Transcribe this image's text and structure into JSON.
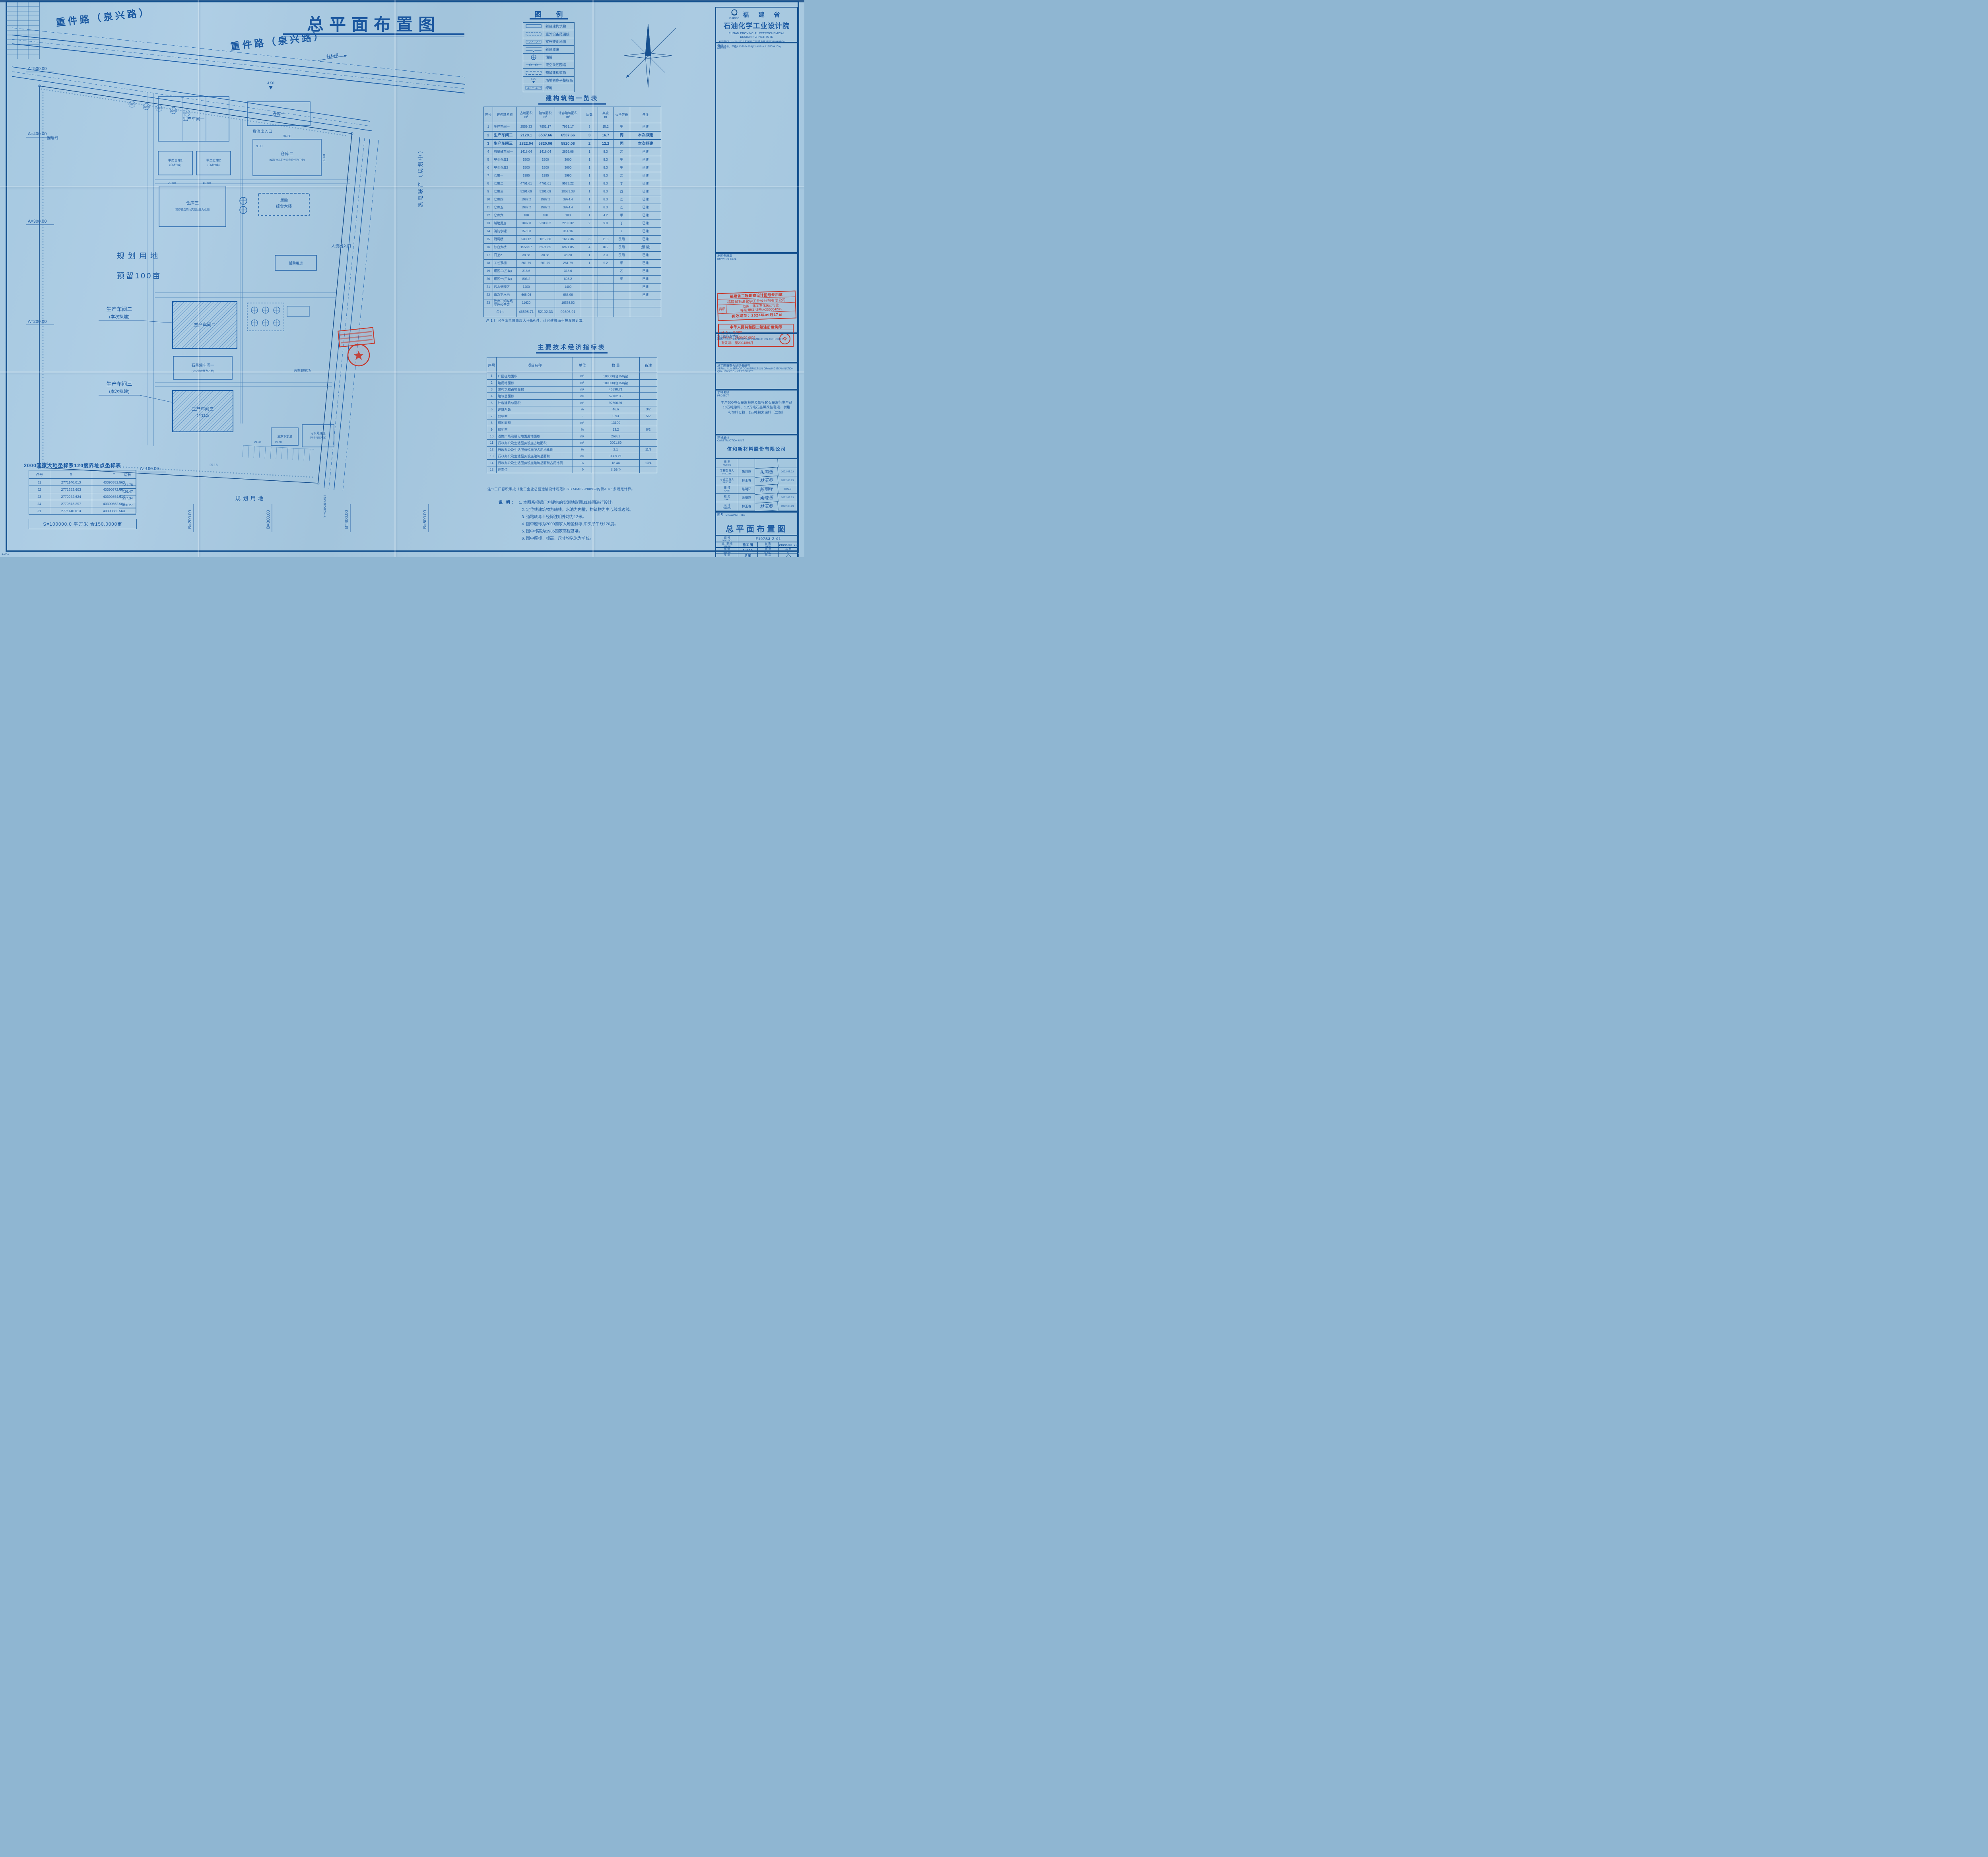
{
  "main_title": "总平面布置图",
  "corner_code": "1.0A1",
  "colors": {
    "ink": "#1c5aa2",
    "frame": "#14518f",
    "stamp_red": "#c5372b"
  },
  "legend": {
    "title": "图 例",
    "items": [
      {
        "symbol": "solid-rect",
        "label": "新建建构筑物"
      },
      {
        "symbol": "dashdot-rect",
        "label": "室外设备范围线"
      },
      {
        "symbol": "hatch-rect",
        "label": "室外硬化地面"
      },
      {
        "symbol": "road",
        "label": "新建道路"
      },
      {
        "symbol": "tank",
        "label": "储罐"
      },
      {
        "symbol": "fence",
        "label": "镂空铁艺围墙"
      },
      {
        "symbol": "dashed-rect",
        "label": "预留建构筑物"
      },
      {
        "symbol": "elevation-mark",
        "label": "场地初步平整标高",
        "value": "4.20"
      },
      {
        "symbol": "green-strip",
        "label": "绿地"
      }
    ]
  },
  "building_table": {
    "title": "建构筑物一览表",
    "headers": [
      {
        "label": "序号",
        "unit": ""
      },
      {
        "label": "建构筑名称",
        "unit": ""
      },
      {
        "label": "占地面积",
        "unit": "m²"
      },
      {
        "label": "建筑面积",
        "unit": "m²"
      },
      {
        "label": "计容建筑面积",
        "unit": "m²"
      },
      {
        "label": "层数",
        "unit": ""
      },
      {
        "label": "高度",
        "unit": "m"
      },
      {
        "label": "火险等级",
        "unit": ""
      },
      {
        "label": "备注",
        "unit": ""
      }
    ],
    "rows": [
      [
        "1",
        "生产车间一",
        "2559.33",
        "7951.17",
        "7951.17",
        "3",
        "15.2",
        "甲",
        "已建"
      ],
      [
        "2",
        "生产车间二",
        "2129.1",
        "6537.66",
        "6537.66",
        "3",
        "16.7",
        "丙",
        "本次拟建"
      ],
      [
        "3",
        "生产车间三",
        "2822.04",
        "5820.06",
        "5820.06",
        "2",
        "12.2",
        "丙",
        "本次拟建"
      ],
      [
        "4",
        "石墨烯车间一",
        "1418.04",
        "1418.04",
        "2836.08",
        "1",
        "8.3",
        "乙",
        "已建"
      ],
      [
        "5",
        "甲类仓库1",
        "1500",
        "1500",
        "3000",
        "1",
        "8.3",
        "甲",
        "已建"
      ],
      [
        "6",
        "甲类仓库2",
        "1500",
        "1500",
        "3000",
        "1",
        "8.3",
        "甲",
        "已建"
      ],
      [
        "7",
        "仓库一",
        "1995",
        "1995",
        "3990",
        "1",
        "8.3",
        "乙",
        "已建"
      ],
      [
        "8",
        "仓库二",
        "4761.61",
        "4761.61",
        "9523.22",
        "1",
        "8.3",
        "丁",
        "已建"
      ],
      [
        "9",
        "仓库三",
        "5291.69",
        "5291.69",
        "10583.38",
        "1",
        "8.3",
        "戊",
        "已建"
      ],
      [
        "10",
        "仓库四",
        "1987.2",
        "1987.2",
        "3974.4",
        "1",
        "8.3",
        "乙",
        "已建"
      ],
      [
        "11",
        "仓库五",
        "1987.2",
        "1987.2",
        "3974.4",
        "1",
        "8.3",
        "乙",
        "已建"
      ],
      [
        "12",
        "仓库六",
        "180",
        "180",
        "180",
        "1",
        "4.2",
        "甲",
        "已建"
      ],
      [
        "13",
        "辅助用房",
        "1097.8",
        "2283.32",
        "2283.32",
        "2",
        "9.0",
        "丁",
        "已建"
      ],
      [
        "14",
        "消防水罐",
        "157.08",
        "",
        "314.16",
        "",
        "",
        "/",
        "已建"
      ],
      [
        "15",
        "附属楼",
        "533.12",
        "1617.36",
        "1617.36",
        "3",
        "11.3",
        "民用",
        "已建"
      ],
      [
        "16",
        "综合大楼",
        "1558.57",
        "6971.85",
        "6971.85",
        "4",
        "16.7",
        "民用",
        "(预 留)"
      ],
      [
        "17",
        "门卫2",
        "38.38",
        "38.38",
        "38.38",
        "1",
        "3.3",
        "民用",
        "已建"
      ],
      [
        "18",
        "工艺泵棚",
        "261.79",
        "261.79",
        "261.79",
        "1",
        "5.2",
        "甲",
        "已建"
      ],
      [
        "19",
        "罐区二(乙类)",
        "318.6",
        "",
        "318.6",
        "",
        "",
        "乙",
        "已建"
      ],
      [
        "20",
        "罐区一(甲类)",
        "803.2",
        "",
        "803.2",
        "",
        "",
        "甲",
        "已建"
      ],
      [
        "21",
        "污水处理区",
        "1400",
        "",
        "1400",
        "",
        "",
        "",
        "已建"
      ],
      [
        "22",
        "清净下水池",
        "668.96",
        "",
        "668.96",
        "",
        "",
        "",
        "已建"
      ],
      [
        "23",
        "管廊、卸车场 室外设备等",
        "11630",
        "",
        "16558.92",
        "",
        "",
        "",
        ""
      ]
    ],
    "total": {
      "label": "合计:",
      "a": "46598.71",
      "b": "52102.33",
      "c": "92606.91"
    },
    "note": "注:1 厂房仓库单层高度大于8米时，计容建筑面积按双层计算。"
  },
  "indicator_table": {
    "title": "主要技术经济指标表",
    "headers": [
      "序号",
      "项目名称",
      "单位",
      "数  量",
      "备注"
    ],
    "rows": [
      [
        "1",
        "厂区征地面积",
        "m²",
        "100000(合150亩)",
        ""
      ],
      [
        "2",
        "建用地面积",
        "m²",
        "100000(合150亩)",
        ""
      ],
      [
        "3",
        "建构筑物占地面积",
        "m²",
        "46598.71",
        ""
      ],
      [
        "4",
        "建筑总面积",
        "m²",
        "52102.33",
        ""
      ],
      [
        "5",
        "计容建筑总面积",
        "m²",
        "92606.91",
        ""
      ],
      [
        "6",
        "建筑系数",
        "%",
        "46.6",
        "3/2"
      ],
      [
        "7",
        "容积率",
        "-",
        "0.93",
        "5/2"
      ],
      [
        "8",
        "绿地面积",
        "m²",
        "13190",
        ""
      ],
      [
        "9",
        "绿地率",
        "%",
        "13.2",
        "8/2"
      ],
      [
        "10",
        "道路广场及硬化地面用地面积",
        "m²",
        "26882",
        ""
      ],
      [
        "11",
        "行政办公及生活服务设施占地面积",
        "m²",
        "2091.69",
        ""
      ],
      [
        "12",
        "行政办公及生活服务设施所占用地比例",
        "%",
        "2.1",
        "11/2"
      ],
      [
        "13",
        "行政办公及生活服务设施建筑总面积",
        "m²",
        "8589.21",
        ""
      ],
      [
        "14",
        "行政办公及生活服务设施建筑总面积占用比例",
        "%",
        "18.44",
        "13/4"
      ],
      [
        "15",
        "停车位",
        "个",
        "共93个",
        ""
      ]
    ],
    "note": "注:1工厂容积率按《化工企业总图运输设计规范》GB 50489-2009中的第A.4.1条规定计算。"
  },
  "coord_table": {
    "title": "2000国家大地坐标系120度界址点坐标表",
    "headers": [
      "点号",
      "X",
      "Y",
      "边长"
    ],
    "rows": [
      {
        "pt": "J1",
        "x": "2771140.013",
        "y": "40390382.563"
      },
      {
        "pt": "J2",
        "x": "2771272.603",
        "y": "40390572.667"
      },
      {
        "pt": "J3",
        "x": "2770952.624",
        "y": "40390854.614"
      },
      {
        "pt": "J4",
        "x": "2770813.257",
        "y": "40390662.504"
      },
      {
        "pt": "J1",
        "x": "2771140.013",
        "y": "40390382.563"
      }
    ],
    "sides": [
      "231.78",
      "426.47",
      "237.34",
      "430.27"
    ],
    "footer": "S=100000.0 平方米 合150.0000亩"
  },
  "notes": {
    "label": "说 明：",
    "items": [
      "1. 本图系根据厂方提供的实测地形图.红线图进行设计。",
      "2. 定位线建筑物为轴线，水池为内壁，构筑物为中心线或边线。",
      "3. 道路转弯半径除注明外均为12米。",
      "4. 图中座标为2000国家大地坐标系,中央子午线120度。",
      "5. 图中标高为1985国家高程基准。",
      "6. 图中座标、标高、尺寸均以米为单位。"
    ]
  },
  "title_block": {
    "logo": "FJPEC",
    "org_cn1": "福 建 省",
    "org_cn2": "石油化学工业设计院",
    "org_en1": "FUJIAN PROVINCIAL PETROCHEMICAL",
    "org_en2": "DESIGNING INSTITUTE",
    "cert1": "发证部门：中华人民共和国住房和城乡建设部(MOHURD)",
    "cert2": "证书编号：甲级A135004209(CLASS A A135004209)",
    "notes_cn": "备注",
    "notes_en": "NOTES",
    "seal_cn": "出图专用章",
    "seal_en": "DRAWING SEAL",
    "exam_cn": "施工图审查单位",
    "exam_en": "CONSTRUCTION DRAWING EXAMINATION AUTHORITY",
    "serial_cn": "施工图审查合格证书编号",
    "serial_en": "SERIAL NUMBER OF CONSTRUCTION DRAWING EXAMINATION QUALIFICATION CERTIFICATE",
    "project_cn": "工程名称",
    "project_en": "PROJECT",
    "project_l1": "年产500吨石墨烯粉体及规模化石墨烯衍生产品",
    "project_l2": "10万吨涂料、1.2万吨石墨烯改性乳液、树脂",
    "project_l3": "和塑料母粒、2万吨粉末涂料（二期）",
    "unit_cn": "建设单位",
    "unit_en": "CONSTRUCTION UNIT",
    "unit_name": "信和新材料股份有限公司",
    "sign_rows": [
      {
        "cn": "审  定",
        "en": "AUTH'D",
        "name": "",
        "date": ""
      },
      {
        "cn": "工程负责人",
        "en": "PROJ.M.",
        "name": "朱鸿燕",
        "date": "2022.08.23"
      },
      {
        "cn": "专业负责人",
        "en": "SPEC.M.",
        "name": "林玉春",
        "date": "2022.08.23"
      },
      {
        "cn": "审  核",
        "en": "APPR",
        "name": "陈明环",
        "date": "2022.8"
      },
      {
        "cn": "校  对",
        "en": "CHKD",
        "name": "余晓燕",
        "date": "2022.08.23"
      },
      {
        "cn": "设  计",
        "en": "DRAWN",
        "name": "林玉春",
        "date": "2022.08.23"
      }
    ],
    "dtitle_cn": "图名",
    "dtitle_en": "DRAWING TITLE",
    "drawing_title": "总平面布置图",
    "dwgno_cn": "图  号",
    "dwgno_en": "DWG.NO.",
    "dwg_no": "F107S3-Z-01",
    "stage_cn": "设计阶段",
    "stage_en": "STAGE",
    "stage": "施工图",
    "date_cn": "日  期",
    "date_en": "DATE",
    "date": "2022.08.23",
    "scale_cn": "比  例",
    "scale_en": "SCALE",
    "scale": "1:500",
    "sheet_cn": "第  页",
    "sheet_en": "SHEET",
    "of_cn": "共  页",
    "of_en": "OF",
    "spec_cn": "专  业",
    "spec_en": "SPEC.",
    "spec": "总图",
    "rev_cn": "版  次",
    "rev_en": "REV.",
    "rev": "0"
  },
  "stamps": {
    "s1_l1": "福建省工程勘察设计图纸专用章",
    "s1_l2": "福建省石油化学工业设计院有限公司",
    "s1_zz": "资质",
    "s1_scope": "范围：化工石化医药行业",
    "s1_grade": "等级:甲级  证号:A235004206",
    "s1_valid": "有效期至：2024年09月17日",
    "s2_title": "中华人民共和国二级注册建筑师",
    "s2_name": "姓 名：  陈明环",
    "s2_no": "注册号：  3500420-0002",
    "s2_valid": "有效期：  至2024年6月"
  },
  "plan": {
    "road_label_1": "重件路（泉兴路）",
    "road_label_2": "重件路（泉兴路）",
    "to_wharf": "往码头",
    "freight_gate": "货流出入口",
    "people_gate": "人流出入口",
    "fence_label": "围墙线",
    "planning_left_l1": "规划用地",
    "planning_left_l2": "预留100亩",
    "planning_bottom": "规划用地",
    "chp_vertical": "热电联产（规划中）",
    "callout2_l1": "生产车间二",
    "callout2_l2": "(本次拟建)",
    "callout3_l1": "生产车间三",
    "callout3_l2": "(本次拟建)",
    "bld": {
      "ws1": "生产车间一",
      "jia1": "甲类仓库1",
      "jia1_note": "(自动仓库)",
      "jia2": "甲类仓库2",
      "jia2_note": "(自动仓库)",
      "wh1": "仓库一",
      "wh2": "仓库二",
      "wh2_note": "(储存物品的火灾危险性为丁类)",
      "wh3": "仓库三",
      "wh3_note": "(储存物品的火灾危险性为戊类)",
      "complex_note": "(预留)",
      "complex": "综合大楼",
      "aux": "辅助用房",
      "graphene": "石墨烯车间一",
      "graphene_note": "(火灾危险性为乙类)",
      "ws2": "生产车间二",
      "ws3": "生产车间三",
      "ws3_floor": "2F(12.2)",
      "clean": "清净下水池",
      "sewage": "污水处理区",
      "sewage_note": "（不含可燃污油）",
      "truck": "汽车卸车场"
    },
    "dims": {
      "d1": "94.60",
      "d2": "65.60",
      "d3": "29.60",
      "d4": "49.60",
      "d5": "25.13",
      "d6": "21.35",
      "d7": "19.50",
      "e1": "4.50",
      "e2": "9.00"
    },
    "stakes": [
      "3183",
      "3184",
      "3185",
      "3186",
      "3187"
    ],
    "axisA": [
      "A=500.00",
      "A=400.00",
      "A=300.00",
      "A=200.00",
      "A=100.00"
    ],
    "axisB": [
      "B=200.00",
      "B=300.00",
      "B=400.00",
      "B=500.00"
    ],
    "y_coord": "Y=40390854.614"
  }
}
